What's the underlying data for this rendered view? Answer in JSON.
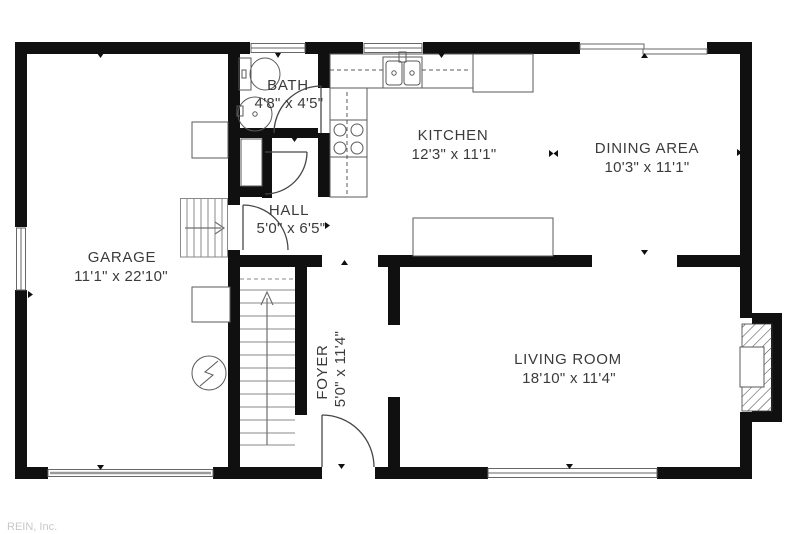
{
  "watermark": "REIN, Inc.",
  "rooms": {
    "garage": {
      "name": "GARAGE",
      "dims": "11'1\" x 22'10\""
    },
    "bath": {
      "name": "BATH",
      "dims": "4'8\" x 4'5\""
    },
    "hall": {
      "name": "HALL",
      "dims": "5'0\" x 6'5\""
    },
    "kitchen": {
      "name": "KITCHEN",
      "dims": "12'3\" x 11'1\""
    },
    "dining": {
      "name": "DINING AREA",
      "dims": "10'3\" x 11'1\""
    },
    "foyer": {
      "name": "FOYER",
      "dims": "5'0\" x 11'4\""
    },
    "living": {
      "name": "LIVING ROOM",
      "dims": "18'10\" x 11'4\""
    }
  },
  "colors": {
    "wall": "#101010",
    "line": "#5a5a5a",
    "text": "#3b3b3b",
    "watermark": "#c8c8c8",
    "bg": "#ffffff"
  }
}
